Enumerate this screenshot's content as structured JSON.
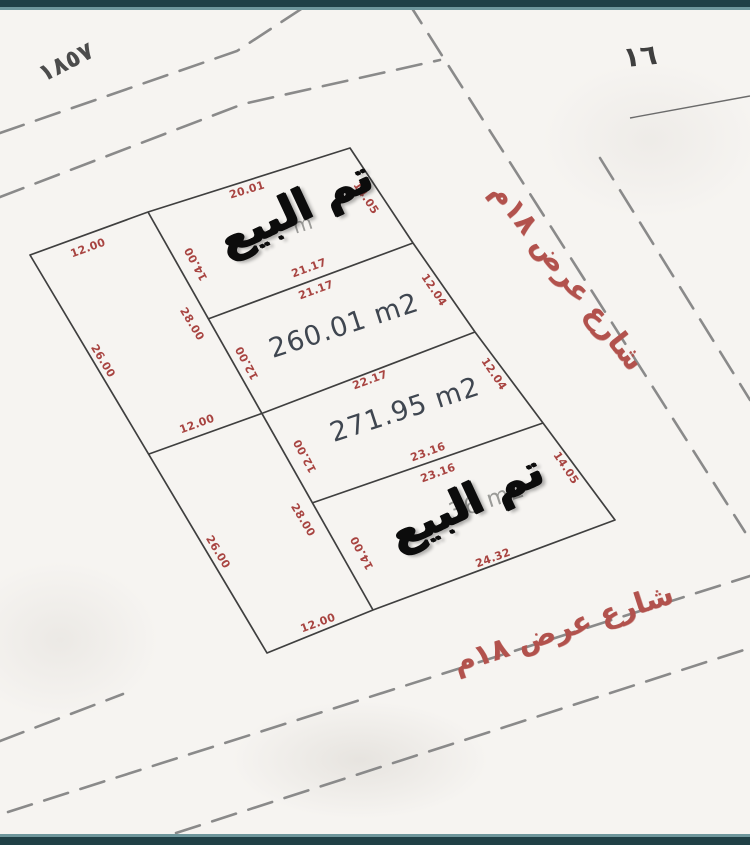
{
  "document_type": "land-subdivision-survey-sketch",
  "colors": {
    "paper": "#f6f4f1",
    "plot_line": "#3f3f3f",
    "dashed_road": "#8a8a8a",
    "dimension_text": "#a84441",
    "area_text": "#3f4650",
    "stamp_text": "#0c0c0c",
    "street_text": "#b2524d",
    "frame_bar": "#204046",
    "frame_bar_accent": "#6f979c"
  },
  "parcel_numbers": {
    "top_left": "١٨٥٧",
    "top_right": "١٦"
  },
  "stamps": {
    "sold": "تم البيع"
  },
  "streets": {
    "right": "شارع عرض ١٨م",
    "bottom": "شارع عرض ١٨م"
  },
  "plots": {
    "left_top": {
      "front_width": "12.00",
      "outer_side": "26.00",
      "inner_side": "28.00"
    },
    "left_bottom": {
      "mid_width": "12.00",
      "outer_side": "26.00",
      "inner_side": "28.00",
      "back_width": "12.00"
    },
    "right_1_sold": {
      "top_edge": "20.01",
      "street_side": "14.05",
      "inner_side": "14.00",
      "area_fragment": "m"
    },
    "right_2": {
      "edge_above": "21.17",
      "edge_below": "21.17",
      "street_side": "12.04",
      "inner_side": "12.00",
      "area": "260.01 m2"
    },
    "right_3": {
      "edge_above": "22.17",
      "street_side": "12.04",
      "inner_side": "12.00",
      "area": "271.95 m2"
    },
    "right_4_sold": {
      "edge_above": "23.16",
      "edge_below": "23.16",
      "street_side": "14.05",
      "inner_side": "14.00",
      "bottom_edge": "24.32",
      "area_fragment": "36 m2"
    }
  }
}
